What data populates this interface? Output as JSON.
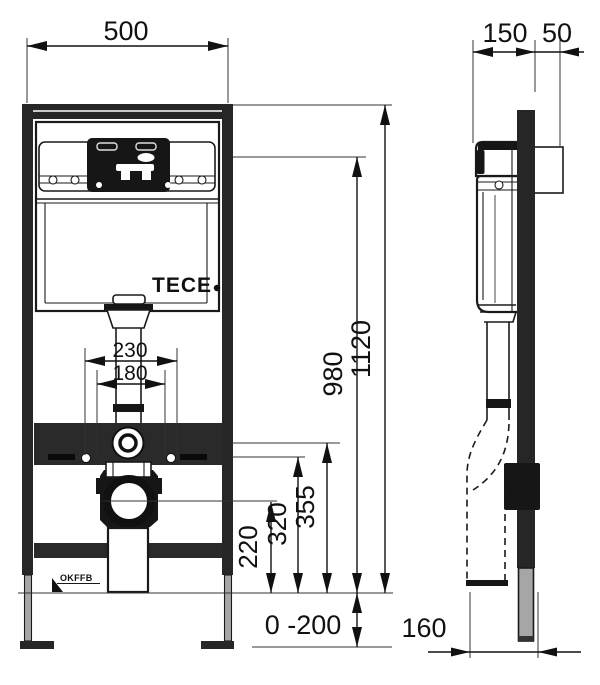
{
  "drawing": {
    "brand_logo": "TECE",
    "floor_marker": "OKFFB",
    "front_view": {
      "width_top": "500",
      "flush_pipe_width": "230",
      "fixing_width": "180",
      "height_total": "1120",
      "height_980": "980",
      "height_355": "355",
      "height_320": "320",
      "height_220": "220",
      "feet_adjust_range": "0 -200"
    },
    "side_view": {
      "depth_150": "150",
      "wall_offset_50": "50",
      "outlet_offset_160": "160"
    },
    "colors": {
      "line": "#1a1a1a",
      "dark_fill": "#262626",
      "foot_gray": "#a6a6a6",
      "background": "#ffffff"
    }
  }
}
